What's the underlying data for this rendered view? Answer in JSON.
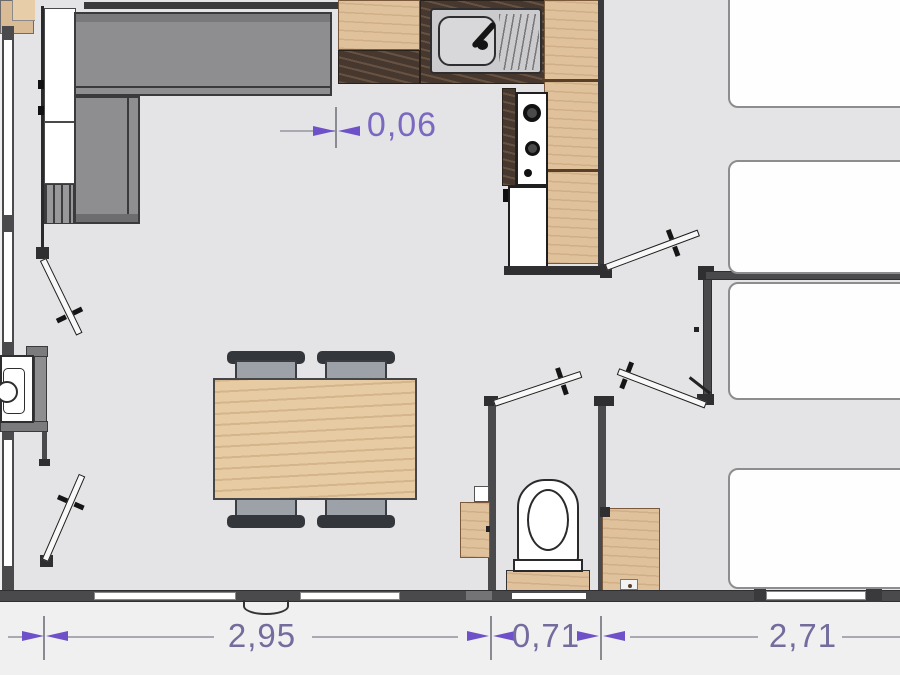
{
  "plan": {
    "type": "floorplan",
    "dimensions": {
      "gap_top": "0,06",
      "bottom_left": "2,95",
      "bottom_middle": "0,71",
      "bottom_right": "2,71"
    },
    "colors": {
      "floor": "#e4e3e6",
      "exterior": "#f1f0f1",
      "wall": "#4a4a4c",
      "wood": "#dfc19b",
      "counter_dark": "#46382e",
      "sofa_gray": "#8e8e90",
      "bed_fill": "#fefefe",
      "dimension_arrow": "#6e51c8",
      "dimension_text_top": "#7b68c0",
      "dimension_text_bottom": "#736c9d"
    }
  }
}
